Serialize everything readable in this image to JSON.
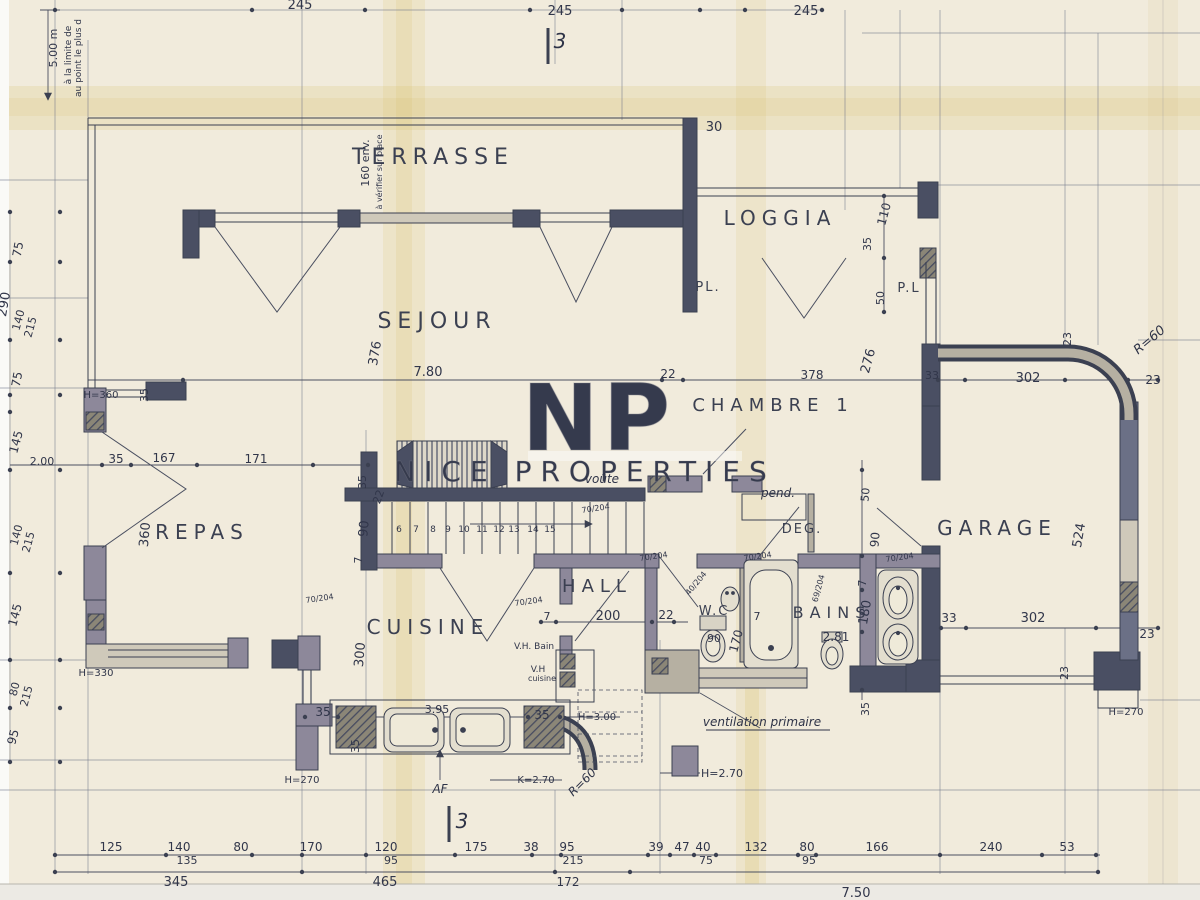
{
  "document": {
    "type": "architect-floor-plan",
    "language": "fr"
  },
  "watermark": {
    "logo": "NP",
    "text": "NICE PROPERTIES"
  },
  "palette": {
    "paper": "#f1ebdc",
    "ink": "#3b4051",
    "stain": "#d9bf66",
    "wall_dark": "#4a4f63",
    "wall_light": "#b6b0a2"
  },
  "rooms": [
    "TERRASSE",
    "LOGGIA",
    "SEJOUR",
    "CHAMBRE 1",
    "REPAS",
    "CUISINE",
    "HALL",
    "DEG.",
    "W.C",
    "BAINS",
    "GARAGE"
  ],
  "labels": [
    {
      "t": "5.00 m",
      "x": 57,
      "y": 48,
      "r": -90,
      "s": 11
    },
    {
      "t": "à la limite de",
      "x": 71,
      "y": 55,
      "r": -90,
      "s": 9,
      "c": "note"
    },
    {
      "t": "au point le plus d",
      "x": 81,
      "y": 58,
      "r": -90,
      "s": 9,
      "c": "note"
    },
    {
      "t": "245",
      "x": 300,
      "y": 9,
      "s": 13
    },
    {
      "t": "245",
      "x": 560,
      "y": 15,
      "s": 13
    },
    {
      "t": "3",
      "x": 560,
      "y": 48,
      "s": 20,
      "c": "hand"
    },
    {
      "t": "245",
      "x": 806,
      "y": 15,
      "s": 13
    },
    {
      "t": "30",
      "x": 714,
      "y": 131,
      "s": 13
    },
    {
      "t": "TERRASSE",
      "x": 433,
      "y": 164,
      "s": 22,
      "c": "room"
    },
    {
      "t": "160 env.",
      "x": 369,
      "y": 163,
      "r": -90,
      "s": 11
    },
    {
      "t": "à vérifier sur place",
      "x": 382,
      "y": 172,
      "r": -90,
      "s": 8,
      "c": "note"
    },
    {
      "t": "LOGGIA",
      "x": 780,
      "y": 225,
      "s": 20,
      "c": "room"
    },
    {
      "t": "110",
      "x": 888,
      "y": 215,
      "r": -75,
      "s": 12
    },
    {
      "t": "35",
      "x": 871,
      "y": 244,
      "r": -90,
      "s": 11
    },
    {
      "t": "PL.",
      "x": 708,
      "y": 291,
      "s": 13,
      "c": "roomsm"
    },
    {
      "t": "P.L",
      "x": 909,
      "y": 292,
      "s": 13,
      "c": "roomsm"
    },
    {
      "t": "50",
      "x": 884,
      "y": 298,
      "r": -90,
      "s": 11
    },
    {
      "t": "SEJOUR",
      "x": 437,
      "y": 328,
      "s": 22,
      "c": "room"
    },
    {
      "t": "376",
      "x": 379,
      "y": 354,
      "r": -80,
      "s": 13
    },
    {
      "t": "7.80",
      "x": 428,
      "y": 376,
      "s": 13
    },
    {
      "t": "22",
      "x": 668,
      "y": 378,
      "s": 12
    },
    {
      "t": "378",
      "x": 812,
      "y": 379,
      "s": 12
    },
    {
      "t": "276",
      "x": 872,
      "y": 362,
      "r": -75,
      "s": 13
    },
    {
      "t": "33",
      "x": 932,
      "y": 379,
      "s": 11
    },
    {
      "t": "CHAMBRE 1",
      "x": 773,
      "y": 411,
      "s": 18,
      "c": "room"
    },
    {
      "t": "23",
      "x": 1071,
      "y": 339,
      "r": -90,
      "s": 11
    },
    {
      "t": "R=60",
      "x": 1152,
      "y": 343,
      "r": -40,
      "s": 13,
      "c": "hand"
    },
    {
      "t": "302",
      "x": 1028,
      "y": 382,
      "s": 13
    },
    {
      "t": "23",
      "x": 1153,
      "y": 384,
      "s": 12
    },
    {
      "t": "H=360",
      "x": 101,
      "y": 398,
      "s": 10,
      "c": "note"
    },
    {
      "t": "35",
      "x": 148,
      "y": 395,
      "r": -90,
      "s": 11
    },
    {
      "t": "75",
      "x": 22,
      "y": 250,
      "r": -80,
      "s": 12
    },
    {
      "t": "290",
      "x": 8,
      "y": 305,
      "r": -80,
      "s": 13
    },
    {
      "t": "140",
      "x": 22,
      "y": 321,
      "r": -75,
      "s": 11
    },
    {
      "t": "215",
      "x": 34,
      "y": 328,
      "r": -75,
      "s": 11
    },
    {
      "t": "75",
      "x": 21,
      "y": 380,
      "r": -80,
      "s": 12
    },
    {
      "t": "145",
      "x": 20,
      "y": 443,
      "r": -75,
      "s": 12
    },
    {
      "t": "2.00",
      "x": 42,
      "y": 465,
      "s": 11
    },
    {
      "t": "35",
      "x": 116,
      "y": 463,
      "s": 12
    },
    {
      "t": "167",
      "x": 164,
      "y": 462,
      "s": 12
    },
    {
      "t": "171",
      "x": 256,
      "y": 463,
      "s": 12
    },
    {
      "t": "35",
      "x": 366,
      "y": 482,
      "r": -90,
      "s": 11
    },
    {
      "t": "140",
      "x": 20,
      "y": 536,
      "r": -75,
      "s": 11
    },
    {
      "t": "215",
      "x": 32,
      "y": 543,
      "r": -75,
      "s": 11
    },
    {
      "t": "145",
      "x": 19,
      "y": 616,
      "r": -75,
      "s": 12
    },
    {
      "t": "80",
      "x": 18,
      "y": 690,
      "r": -75,
      "s": 11
    },
    {
      "t": "215",
      "x": 30,
      "y": 697,
      "r": -75,
      "s": 11
    },
    {
      "t": "95",
      "x": 17,
      "y": 738,
      "r": -75,
      "s": 12
    },
    {
      "t": "REPAS",
      "x": 202,
      "y": 539,
      "s": 20,
      "c": "room"
    },
    {
      "t": "360",
      "x": 149,
      "y": 535,
      "r": -85,
      "s": 13
    },
    {
      "t": "22",
      "x": 382,
      "y": 498,
      "r": -70,
      "s": 11
    },
    {
      "t": "90",
      "x": 368,
      "y": 529,
      "r": -85,
      "s": 13
    },
    {
      "t": "7",
      "x": 362,
      "y": 560,
      "r": -90,
      "s": 11
    },
    {
      "t": "voûte",
      "x": 602,
      "y": 483,
      "s": 12,
      "c": "hand"
    },
    {
      "t": "70/204",
      "x": 596,
      "y": 511,
      "r": -8,
      "s": 8,
      "c": "note"
    },
    {
      "t": "70/204",
      "x": 654,
      "y": 559,
      "r": -8,
      "s": 8,
      "c": "note"
    },
    {
      "t": "pend.",
      "x": 778,
      "y": 497,
      "s": 12,
      "c": "hand"
    },
    {
      "t": "DEG.",
      "x": 802,
      "y": 533,
      "s": 13,
      "c": "roomsm"
    },
    {
      "t": "50",
      "x": 869,
      "y": 495,
      "r": -85,
      "s": 11
    },
    {
      "t": "90",
      "x": 879,
      "y": 540,
      "r": -85,
      "s": 12
    },
    {
      "t": "70/204",
      "x": 900,
      "y": 560,
      "r": -8,
      "s": 8,
      "c": "note"
    },
    {
      "t": "GARAGE",
      "x": 997,
      "y": 535,
      "s": 20,
      "c": "room"
    },
    {
      "t": "524",
      "x": 1083,
      "y": 536,
      "r": -80,
      "s": 13
    },
    {
      "t": "6",
      "x": 399,
      "y": 532,
      "s": 9
    },
    {
      "t": "7",
      "x": 416,
      "y": 532,
      "s": 9
    },
    {
      "t": "8",
      "x": 433,
      "y": 532,
      "s": 9
    },
    {
      "t": "9",
      "x": 448,
      "y": 532,
      "s": 9
    },
    {
      "t": "10",
      "x": 464,
      "y": 532,
      "s": 9
    },
    {
      "t": "11",
      "x": 482,
      "y": 532,
      "s": 9
    },
    {
      "t": "12",
      "x": 499,
      "y": 532,
      "s": 9
    },
    {
      "t": "13",
      "x": 514,
      "y": 532,
      "s": 9
    },
    {
      "t": "14",
      "x": 533,
      "y": 532,
      "s": 9
    },
    {
      "t": "15",
      "x": 550,
      "y": 532,
      "s": 9
    },
    {
      "t": "HALL",
      "x": 597,
      "y": 592,
      "s": 18,
      "c": "room"
    },
    {
      "t": "70/204",
      "x": 320,
      "y": 601,
      "r": -8,
      "s": 8,
      "c": "note"
    },
    {
      "t": "70/204",
      "x": 529,
      "y": 604,
      "r": -8,
      "s": 8,
      "c": "note"
    },
    {
      "t": "7",
      "x": 547,
      "y": 620,
      "s": 11
    },
    {
      "t": "200",
      "x": 608,
      "y": 620,
      "s": 13
    },
    {
      "t": "22",
      "x": 666,
      "y": 619,
      "s": 12
    },
    {
      "t": "W.C",
      "x": 714,
      "y": 615,
      "s": 13,
      "c": "roomsm"
    },
    {
      "t": "40/204",
      "x": 698,
      "y": 585,
      "r": -50,
      "s": 8,
      "c": "note"
    },
    {
      "t": "70/204",
      "x": 758,
      "y": 559,
      "r": -8,
      "s": 8,
      "c": "note"
    },
    {
      "t": "69/204",
      "x": 821,
      "y": 589,
      "r": -75,
      "s": 8,
      "c": "note"
    },
    {
      "t": "90",
      "x": 714,
      "y": 642,
      "s": 11
    },
    {
      "t": "170",
      "x": 740,
      "y": 642,
      "r": -75,
      "s": 12
    },
    {
      "t": "7",
      "x": 757,
      "y": 620,
      "s": 11
    },
    {
      "t": "BAINS",
      "x": 832,
      "y": 618,
      "s": 16,
      "c": "room"
    },
    {
      "t": "2.81",
      "x": 836,
      "y": 641,
      "s": 12
    },
    {
      "t": "7",
      "x": 866,
      "y": 583,
      "r": -90,
      "s": 11
    },
    {
      "t": "180",
      "x": 869,
      "y": 613,
      "r": -80,
      "s": 13
    },
    {
      "t": "33",
      "x": 949,
      "y": 622,
      "s": 12
    },
    {
      "t": "302",
      "x": 1033,
      "y": 622,
      "s": 13
    },
    {
      "t": "23",
      "x": 1147,
      "y": 638,
      "s": 12
    },
    {
      "t": "23",
      "x": 1068,
      "y": 673,
      "r": -90,
      "s": 11
    },
    {
      "t": "CUISINE",
      "x": 428,
      "y": 634,
      "s": 20,
      "c": "room"
    },
    {
      "t": "300",
      "x": 364,
      "y": 655,
      "r": -85,
      "s": 13
    },
    {
      "t": "V.H. Bain",
      "x": 534,
      "y": 649,
      "s": 9,
      "c": "note"
    },
    {
      "t": "V.H",
      "x": 538,
      "y": 672,
      "s": 9,
      "c": "note"
    },
    {
      "t": "cuisine",
      "x": 542,
      "y": 681,
      "s": 8,
      "c": "note"
    },
    {
      "t": "35",
      "x": 323,
      "y": 716,
      "s": 12
    },
    {
      "t": "3.95",
      "x": 437,
      "y": 713,
      "s": 11
    },
    {
      "t": "35",
      "x": 542,
      "y": 719,
      "s": 12
    },
    {
      "t": "H=3.00",
      "x": 597,
      "y": 720,
      "s": 10,
      "c": "note"
    },
    {
      "t": "35",
      "x": 359,
      "y": 746,
      "r": -90,
      "s": 11
    },
    {
      "t": "H=270",
      "x": 302,
      "y": 783,
      "s": 10,
      "c": "note"
    },
    {
      "t": "K=2.70",
      "x": 536,
      "y": 783,
      "s": 10,
      "c": "note"
    },
    {
      "t": "AF",
      "x": 440,
      "y": 793,
      "s": 12,
      "c": "hand"
    },
    {
      "t": "R=60",
      "x": 585,
      "y": 785,
      "r": -45,
      "s": 12,
      "c": "hand"
    },
    {
      "t": "H=330",
      "x": 96,
      "y": 676,
      "s": 10,
      "c": "note"
    },
    {
      "t": "ventilation primaire",
      "x": 762,
      "y": 726,
      "s": 12,
      "c": "hand"
    },
    {
      "t": "H=2.70",
      "x": 722,
      "y": 777,
      "s": 11,
      "c": "note"
    },
    {
      "t": "35",
      "x": 869,
      "y": 709,
      "r": -90,
      "s": 11
    },
    {
      "t": "H=270",
      "x": 1126,
      "y": 715,
      "s": 10,
      "c": "note"
    },
    {
      "t": "125",
      "x": 111,
      "y": 851,
      "s": 12
    },
    {
      "t": "140",
      "x": 179,
      "y": 851,
      "s": 12
    },
    {
      "t": "135",
      "x": 187,
      "y": 864,
      "s": 11
    },
    {
      "t": "80",
      "x": 241,
      "y": 851,
      "s": 12
    },
    {
      "t": "170",
      "x": 311,
      "y": 851,
      "s": 12
    },
    {
      "t": "120",
      "x": 386,
      "y": 851,
      "s": 12
    },
    {
      "t": "95",
      "x": 391,
      "y": 864,
      "s": 11
    },
    {
      "t": "175",
      "x": 476,
      "y": 851,
      "s": 12
    },
    {
      "t": "38",
      "x": 531,
      "y": 851,
      "s": 12
    },
    {
      "t": "95",
      "x": 567,
      "y": 851,
      "s": 12
    },
    {
      "t": "215",
      "x": 573,
      "y": 864,
      "s": 11
    },
    {
      "t": "39",
      "x": 656,
      "y": 851,
      "s": 12
    },
    {
      "t": "47",
      "x": 682,
      "y": 851,
      "s": 12
    },
    {
      "t": "40",
      "x": 703,
      "y": 851,
      "s": 12
    },
    {
      "t": "75",
      "x": 706,
      "y": 864,
      "s": 11
    },
    {
      "t": "132",
      "x": 756,
      "y": 851,
      "s": 12
    },
    {
      "t": "80",
      "x": 807,
      "y": 851,
      "s": 12
    },
    {
      "t": "95",
      "x": 809,
      "y": 864,
      "s": 11
    },
    {
      "t": "166",
      "x": 877,
      "y": 851,
      "s": 12
    },
    {
      "t": "240",
      "x": 991,
      "y": 851,
      "s": 12
    },
    {
      "t": "53",
      "x": 1067,
      "y": 851,
      "s": 12
    },
    {
      "t": "345",
      "x": 176,
      "y": 886,
      "s": 13
    },
    {
      "t": "465",
      "x": 385,
      "y": 886,
      "s": 13
    },
    {
      "t": "172",
      "x": 568,
      "y": 886,
      "s": 12
    },
    {
      "t": "7.50",
      "x": 856,
      "y": 897,
      "s": 13
    },
    {
      "t": "3",
      "x": 462,
      "y": 828,
      "s": 20,
      "c": "hand"
    }
  ],
  "ticks": [
    [
      55,
      10
    ],
    [
      252,
      10
    ],
    [
      365,
      10
    ],
    [
      530,
      10
    ],
    [
      622,
      10
    ],
    [
      700,
      10
    ],
    [
      745,
      10
    ],
    [
      822,
      10
    ],
    [
      55,
      855
    ],
    [
      166,
      855
    ],
    [
      252,
      855
    ],
    [
      302,
      855
    ],
    [
      366,
      855
    ],
    [
      455,
      855
    ],
    [
      532,
      855
    ],
    [
      561,
      855
    ],
    [
      648,
      855
    ],
    [
      670,
      855
    ],
    [
      694,
      855
    ],
    [
      716,
      855
    ],
    [
      798,
      855
    ],
    [
      816,
      855
    ],
    [
      940,
      855
    ],
    [
      1042,
      855
    ],
    [
      1096,
      855
    ],
    [
      55,
      872
    ],
    [
      302,
      872
    ],
    [
      555,
      872
    ],
    [
      630,
      872
    ],
    [
      1098,
      872
    ],
    [
      183,
      380
    ],
    [
      662,
      380
    ],
    [
      683,
      380
    ],
    [
      938,
      380
    ],
    [
      965,
      380
    ],
    [
      1065,
      380
    ],
    [
      1128,
      380
    ],
    [
      1158,
      380
    ],
    [
      102,
      465
    ],
    [
      131,
      465
    ],
    [
      197,
      465
    ],
    [
      313,
      465
    ],
    [
      368,
      465
    ],
    [
      541,
      622
    ],
    [
      556,
      622
    ],
    [
      652,
      622
    ],
    [
      674,
      622
    ],
    [
      941,
      628
    ],
    [
      966,
      628
    ],
    [
      1096,
      628
    ],
    [
      1158,
      628
    ],
    [
      305,
      717
    ],
    [
      338,
      717
    ],
    [
      528,
      717
    ],
    [
      560,
      717
    ],
    [
      862,
      470
    ],
    [
      862,
      556
    ],
    [
      862,
      590
    ],
    [
      862,
      632
    ],
    [
      862,
      690
    ],
    [
      884,
      196
    ],
    [
      884,
      258
    ],
    [
      884,
      312
    ],
    [
      10,
      212
    ],
    [
      10,
      262
    ],
    [
      10,
      340
    ],
    [
      10,
      395
    ],
    [
      10,
      412
    ],
    [
      10,
      470
    ],
    [
      10,
      573
    ],
    [
      10,
      660
    ],
    [
      10,
      708
    ],
    [
      10,
      762
    ],
    [
      60,
      212
    ],
    [
      60,
      262
    ],
    [
      60,
      340
    ],
    [
      60,
      395
    ],
    [
      60,
      470
    ],
    [
      60,
      573
    ],
    [
      60,
      660
    ],
    [
      60,
      708
    ],
    [
      60,
      762
    ]
  ],
  "stairs": {
    "first_step_x": 392,
    "step_count": 15,
    "step_pitch": 18,
    "top_y": 502,
    "bottom_y": 554
  }
}
